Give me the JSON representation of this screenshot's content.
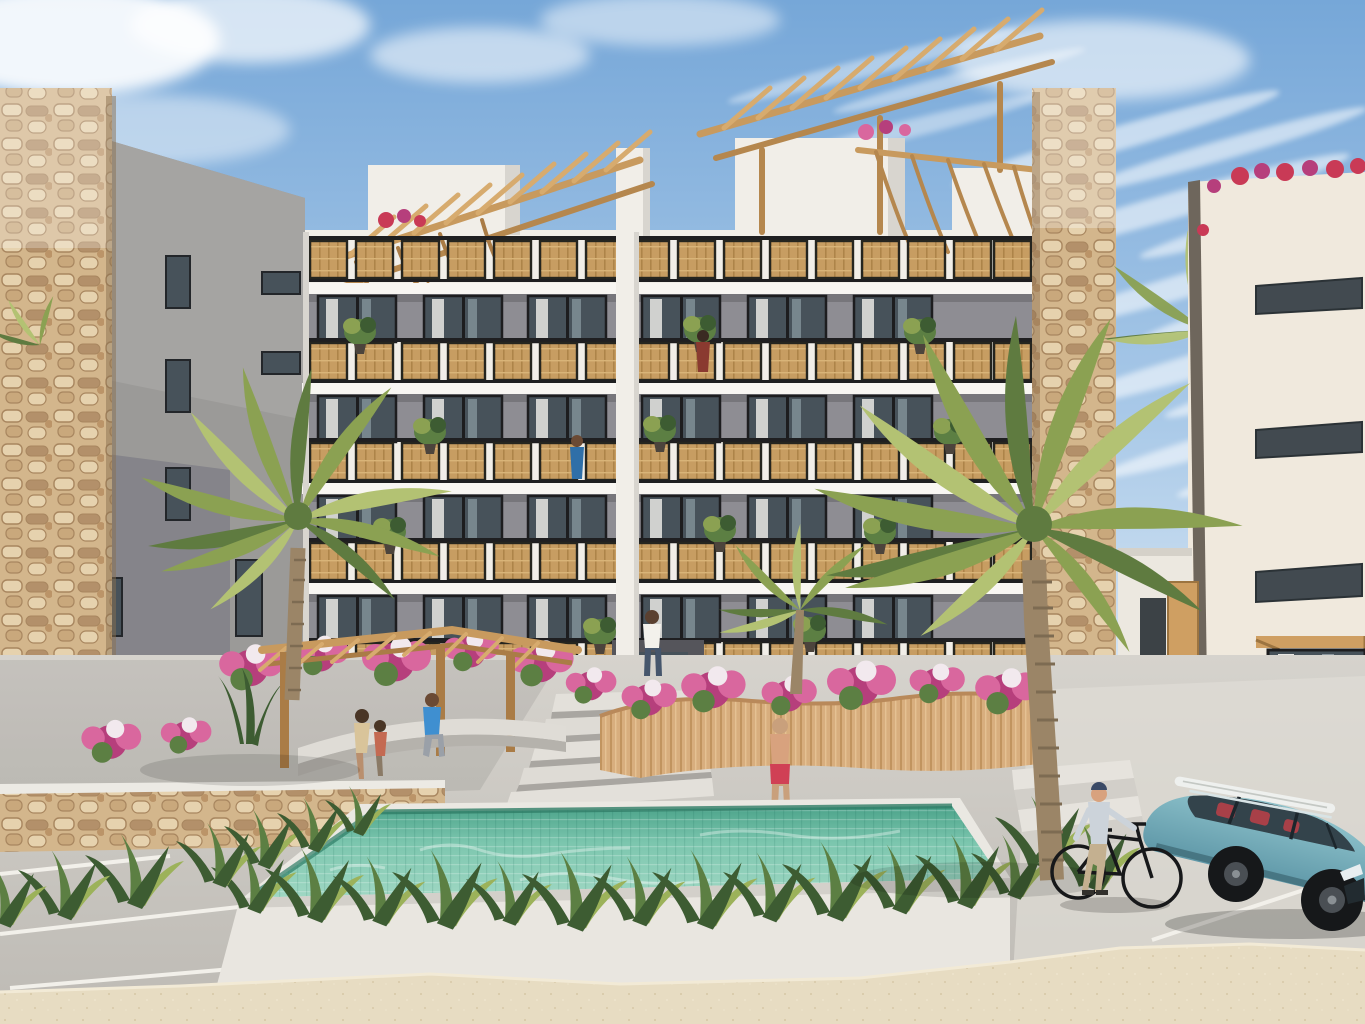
{
  "meta": {
    "type": "architectural-rendering",
    "subject": "Beachfront condominium exterior with rooftop pergolas, pool, palms, parking",
    "floors_visible": 5,
    "balcony_rows": 5,
    "people_count": 8,
    "palm_trees_foreground": 3
  },
  "scene": {
    "sky": "blue sky with wispy white cirrus clouds, denser streaks on the right",
    "main_building": "white five-storey condo, rattan-panel balcony railings, wooden rooftop pergolas, stone-clad side column, central entrance with stairs",
    "left_building": "grey concrete block with tan rubble-stone corner column, small dark windows, ground-level garage opening",
    "right_building": "cream facade with horizontal slit windows, rooftop bougainvillea, wooden door at street level",
    "pool": "rectangular turquoise mosaic-tile pool in white planter box fringed with ferns",
    "garden": "pink and magenta bougainvillea beds, curved wooden planter wall, wooden pergola over curved concrete bench",
    "vehicles": "teal SUV with white surfboard on roof rails; man pushing a black bicycle",
    "ground": "grey paved plaza, white parking stall lines, tan stone retaining wall, sandy unpaved foreground strip",
    "people": [
      "woman seated on curved bench",
      "child seated on curved bench",
      "man in blue t-shirt seated on bench",
      "man in white shirt at entrance",
      "man in swim trunks walking to pool",
      "man on third-floor balcony",
      "woman on fourth-floor balcony",
      "cyclist pushing bicycle"
    ]
  },
  "palette": {
    "sky_top": "#76a7d8",
    "sky_mid": "#a9c9e8",
    "sky_horizon": "#e4eef6",
    "cloud": "#ffffff",
    "bldg_white": "#f1eee8",
    "bldg_shade": "#d8d5cf",
    "slab": "#f8f6f2",
    "interior_grey": "#8e8d93",
    "interior_dark": "#6c6b71",
    "glass_dark": "#47525a",
    "curtain": "#e9e8e4",
    "rail_black": "#1f1f21",
    "rattan": "#c79d62",
    "rattan_dark": "#ad8449",
    "wood": "#cf9f62",
    "wood_dark": "#aa7c46",
    "stone_base": "#d3b68c",
    "stone_dark": "#b3906a",
    "stone_light": "#e6d2ae",
    "grey_bldg": "#9b9a98",
    "grey_bldg_dark": "#85848a",
    "garage_dark": "#2f2d2b",
    "right_bldg": "#f0e9dd",
    "window_slit": "#424a50",
    "palm_green": "#8ba152",
    "palm_dark": "#5f7b40",
    "palm_light": "#b3c273",
    "trunk": "#9b8567",
    "pool_water": "#7cc6ae",
    "pool_light": "#a9dcc9",
    "pool_dark": "#4ba38a",
    "pool_edge": "#2f7d66",
    "fern_dark": "#3d5c32",
    "fern_mid": "#5c7f43",
    "fern_light": "#9cb25a",
    "flower_pink": "#d9679e",
    "flower_magenta": "#b63f7c",
    "flower_white": "#f2e9ee",
    "flower_red": "#c93a56",
    "planter_wood": "#d8ae7e",
    "terracotta": "#c07b52",
    "pavement": "#d6d3cd",
    "pavement_dark": "#bdbab4",
    "sand": "#e7dcc2",
    "bench": "#dfdcd6",
    "car_teal": "#8fc3cc",
    "car_teal_dark": "#5f98a8",
    "car_window": "#33434b",
    "car_seat": "#a84048",
    "wheel": "#16181a",
    "surfboard": "#eef0ee",
    "skin": "#d8a27e",
    "shirt_white": "#f3f1ec",
    "shirt_blue": "#3f8fd0",
    "jeans": "#46566c",
    "trunks": "#d04055",
    "cyclist_shirt": "#ccd3da",
    "cyclist_pants": "#c4b090"
  }
}
